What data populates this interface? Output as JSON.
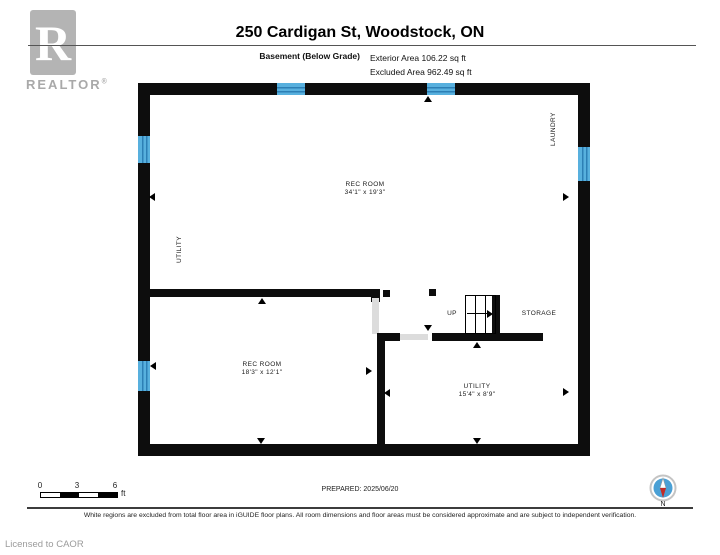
{
  "header": {
    "logo_letter": "R",
    "brand": "REALTOR",
    "registered": "®",
    "title": "250 Cardigan St, Woodstock, ON",
    "floor_label": "Basement (Below Grade)",
    "exterior_area": "Exterior Area 106.22 sq ft",
    "excluded_area": "Excluded Area 962.49 sq ft"
  },
  "plan": {
    "rooms": [
      {
        "name": "REC ROOM",
        "dims": "34'1\" x 19'3\""
      },
      {
        "name": "REC ROOM",
        "dims": "18'3\" x 12'1\""
      },
      {
        "name": "UTILITY",
        "dims": "15'4\" x 8'9\""
      }
    ],
    "side_labels": {
      "laundry": "LAUNDRY",
      "utility": "UTILITY",
      "up": "UP",
      "storage": "STORAGE"
    }
  },
  "footer": {
    "scale_ticks": [
      "0",
      "3",
      "6"
    ],
    "scale_unit": "ft",
    "prepared": "PREPARED: 2025/06/20",
    "compass_label": "N",
    "disclaimer": "White regions are excluded from total floor area in iGUIDE floor plans. All room dimensions and floor areas must be considered approximate and are subject to independent verification.",
    "license": "Licensed to CAOR"
  },
  "colors": {
    "wall": "#0d0d0d",
    "window_blue": "#58b0de",
    "window_stripe": "#2d7fb5",
    "opening_gray": "#dcdcdc",
    "logo_gray": "#b4b4b4",
    "compass_blue": "#4aa0d5",
    "needle_red": "#c22b27"
  }
}
